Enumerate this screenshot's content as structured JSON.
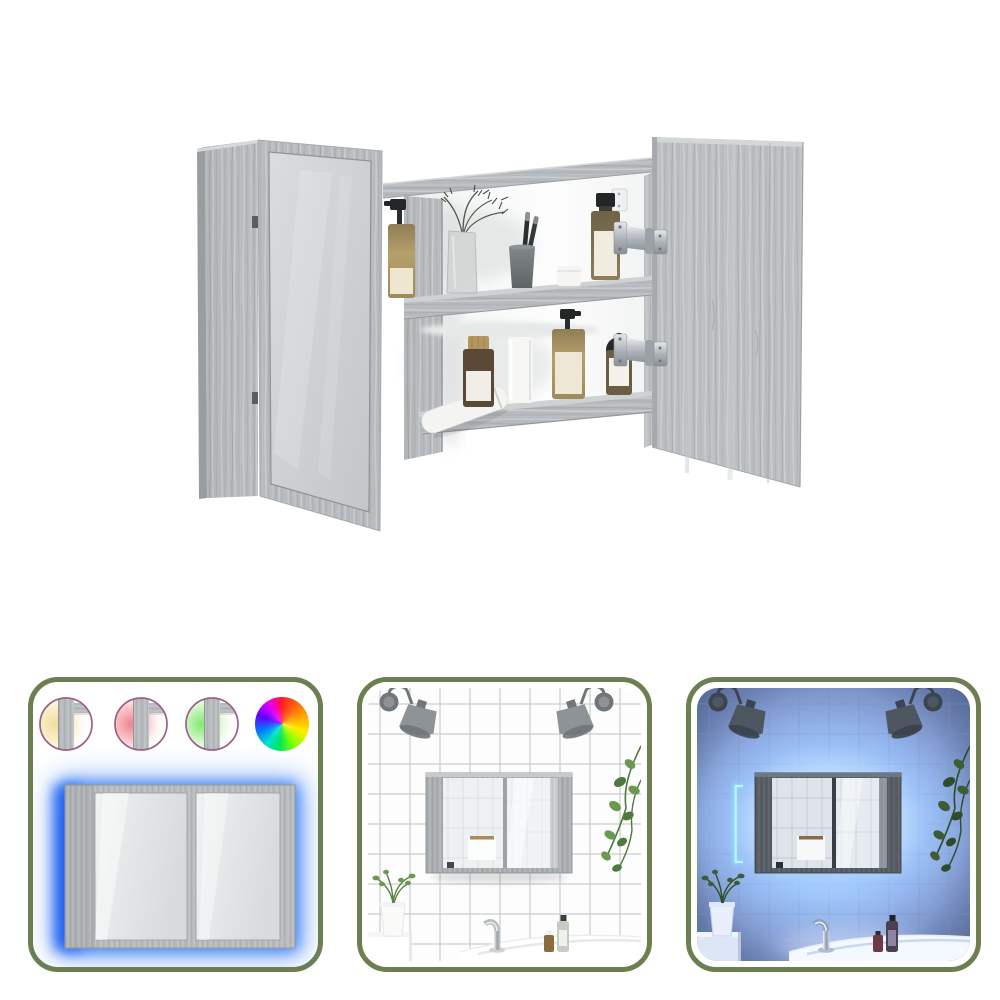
{
  "page": {
    "background": "#ffffff",
    "content_type": "product-image-set"
  },
  "main_view": {
    "name": "led-mirror-cabinet-open",
    "finish": "grey-sonoma-wood",
    "wood_base": "#b4b8ba",
    "wood_light": "#ccd0d2",
    "wood_dark": "#9ca1a3",
    "mirror_tint": "#ccd0d1",
    "hinge_metal": "#aeb4b9",
    "top_shelf_items": [
      "amber-pump-bottle",
      "glass-vase-with-dried-stems",
      "toothbrush-cup",
      "white-cream-jar",
      "amber-bottle-black-cap"
    ],
    "bottom_shelf_items": [
      "white-tube",
      "amber-bottle-wooden-cap",
      "white-cylinder-bottle",
      "amber-pump-bottle",
      "dark-dropper-bottle"
    ]
  },
  "panels": [
    {
      "name": "led-color-options",
      "border_color": "#6b7f50",
      "swatch_ring_color": "#9e5f86",
      "swatches": [
        {
          "name": "warm-white-led",
          "core": "#f2dd9d",
          "soft": "#faf2d2"
        },
        {
          "name": "red-led",
          "core": "#f0838e",
          "soft": "#fad3d6"
        },
        {
          "name": "green-led",
          "core": "#80e971",
          "soft": "#dcf9d3"
        }
      ],
      "rgb_wheel": [
        "#ff2121",
        "#ff9800",
        "#ffee00",
        "#7dff00",
        "#00e65a",
        "#00e0cf",
        "#0077ff",
        "#6200ff",
        "#d900ff",
        "#ff00a6"
      ],
      "glow_color": "#2f76f2",
      "glow_core": "#1e5ff0"
    },
    {
      "name": "bathroom-daylight",
      "border_color": "#6b7f50",
      "wall": "#fcfdfc",
      "grout": "#c9ccc9",
      "lamp": "#8d9396",
      "lamp_dark": "#70767a",
      "plant": "#6a9a52",
      "plant_dark": "#4e7a40",
      "sink": "#ffffff",
      "cabinet_wood": "#a8acae"
    },
    {
      "name": "bathroom-led-night",
      "border_color": "#6b7f50",
      "wall": "#8ca6dd",
      "glow": "#9cc6ff",
      "glow_bright": "#bfe0ff",
      "grout": "#7d92c4",
      "led_strip": "#8deaff",
      "lamp": "#4e5761",
      "plant": "#3d5c33",
      "sink": "#f4f8ff",
      "cabinet_wood": "#565c62"
    }
  ]
}
